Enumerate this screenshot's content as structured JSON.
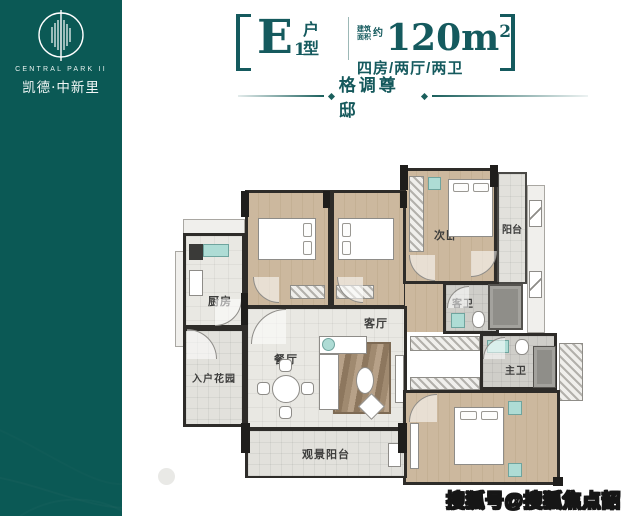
{
  "brand": {
    "name_en": "CENTRAL PARK II",
    "name_cn": "凯德·中新里"
  },
  "unit": {
    "code_letter": "E",
    "code_sub": "1",
    "type_char_1": "户",
    "type_char_2": "型",
    "area_label_1": "建筑",
    "area_label_2": "面积",
    "area_approx": "约",
    "area_value": "120m",
    "area_sup": "2",
    "layout_desc": "四房/两厅/两卫"
  },
  "tagline": "格调尊邸",
  "rooms": {
    "bedroom_a": "次卧",
    "bedroom_b": "次卧",
    "bedroom_c": "次卧",
    "balcony": "阳台",
    "kitchen": "厨房",
    "entry_garden": "入户花园",
    "living_room": "客厅",
    "dining_room": "餐厅",
    "guest_bath": "客卫",
    "master_bath": "主卫",
    "master_bedroom": "主卧",
    "view_balcony": "观景阳台"
  },
  "watermark": {
    "text": "搜狐号@搜狐焦点韶关站"
  },
  "colors": {
    "sidebar_teal": "#0b5955",
    "title_teal": "#155a5e",
    "wall": "#2e2c29",
    "wood_floor": "#ccb89e",
    "tile_floor": "#e9e8e3",
    "bath_floor": "#cfcec9",
    "rug": "#a08a70",
    "fixture_teal": "#aedcd5"
  }
}
